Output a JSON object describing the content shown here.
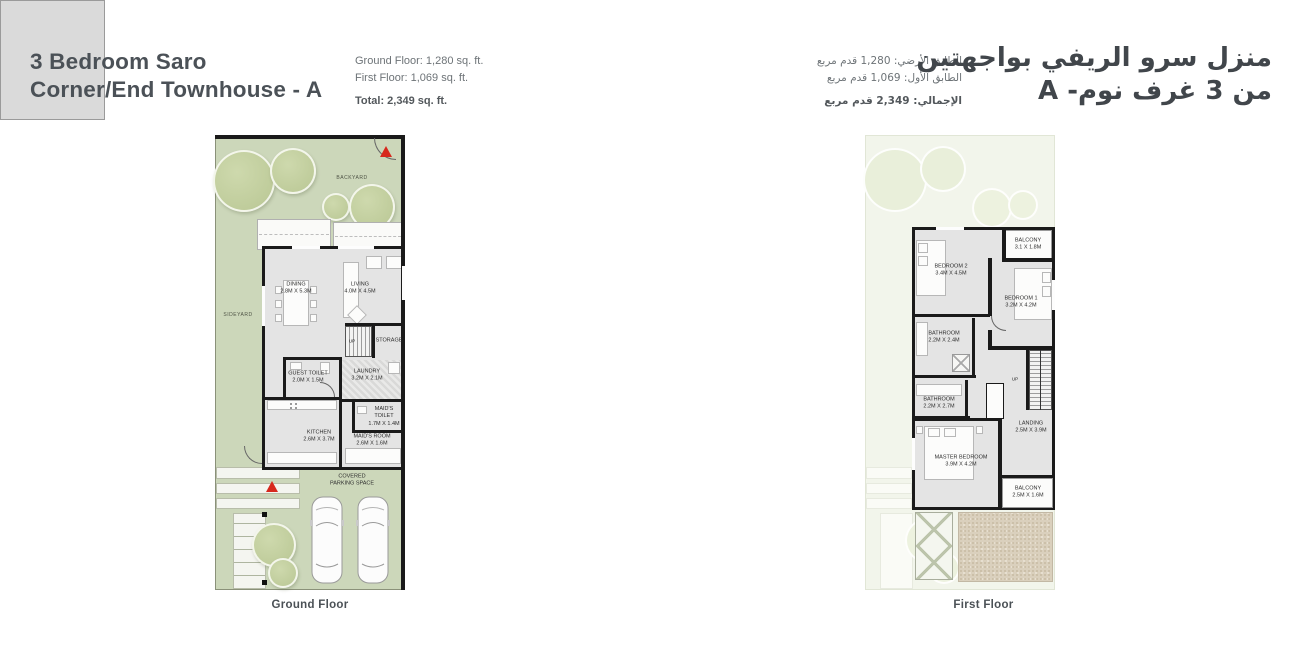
{
  "header": {
    "title_en_line1": "3 Bedroom Saro",
    "title_en_line2": "Corner/End Townhouse - A",
    "stats_en": {
      "ground": "Ground Floor: 1,280 sq. ft.",
      "first": "First Floor: 1,069 sq. ft.",
      "total": "Total: 2,349 sq. ft."
    },
    "title_ar_line1": "منزل سرو الريفي بواجهتين",
    "title_ar_line2": "من 3 غرف نوم- A",
    "stats_ar": {
      "ground": "الطابق الأرضي: 1,280 قدم مربع",
      "first": "الطابق الأول: 1,069 قدم مربع",
      "total": "الإجمالي: 2,349 قدم مربع"
    }
  },
  "ground_floor": {
    "caption": "Ground Floor",
    "yard_labels": {
      "backyard": "BACKYARD",
      "sideyard": "SIDEYARD"
    },
    "up_label": "UP",
    "rooms": [
      {
        "name": "DINING",
        "dims": "2.8M X 5.3M"
      },
      {
        "name": "LIVING",
        "dims": "4.0M X 4.5M"
      },
      {
        "name": "STORAGE",
        "dims": ""
      },
      {
        "name": "GUEST TOILET",
        "dims": "2.0M X 1.5M"
      },
      {
        "name": "LAUNDRY",
        "dims": "3.2M X 2.1M"
      },
      {
        "name": "KITCHEN",
        "dims": "2.6M X 3.7M"
      },
      {
        "name": "MAID'S TOILET",
        "dims": "1.7M X 1.4M"
      },
      {
        "name": "MAID'S ROOM",
        "dims": "2.6M X 1.6M"
      },
      {
        "name": "COVERED PARKING SPACE",
        "dims": ""
      }
    ]
  },
  "first_floor": {
    "caption": "First Floor",
    "up_label": "UP",
    "rooms": [
      {
        "name": "BALCONY",
        "dims": "3.1 X 1.8M"
      },
      {
        "name": "BEDROOM 2",
        "dims": "3.4M X 4.5M"
      },
      {
        "name": "BEDROOM 1",
        "dims": "3.2M X 4.2M"
      },
      {
        "name": "BATHROOM",
        "dims": "2.2M X 2.4M"
      },
      {
        "name": "BATHROOM",
        "dims": "2.2M X 2.7M"
      },
      {
        "name": "LANDING",
        "dims": "2.5M X 3.9M"
      },
      {
        "name": "MASTER BEDROOM",
        "dims": "3.9M X 4.2M"
      },
      {
        "name": "BALCONY",
        "dims": "2.5M X 1.6M"
      }
    ]
  },
  "colors": {
    "title_text": "#4b5157",
    "body_text": "#6d7377",
    "yard_green": "#ccd7ba",
    "tree_green": "#bfcc9b",
    "house_gray": "#e4e4e4",
    "wall_black": "#1a1a1a",
    "arrow_red": "#d7281d",
    "terrace_beige": "#dad0bd"
  }
}
